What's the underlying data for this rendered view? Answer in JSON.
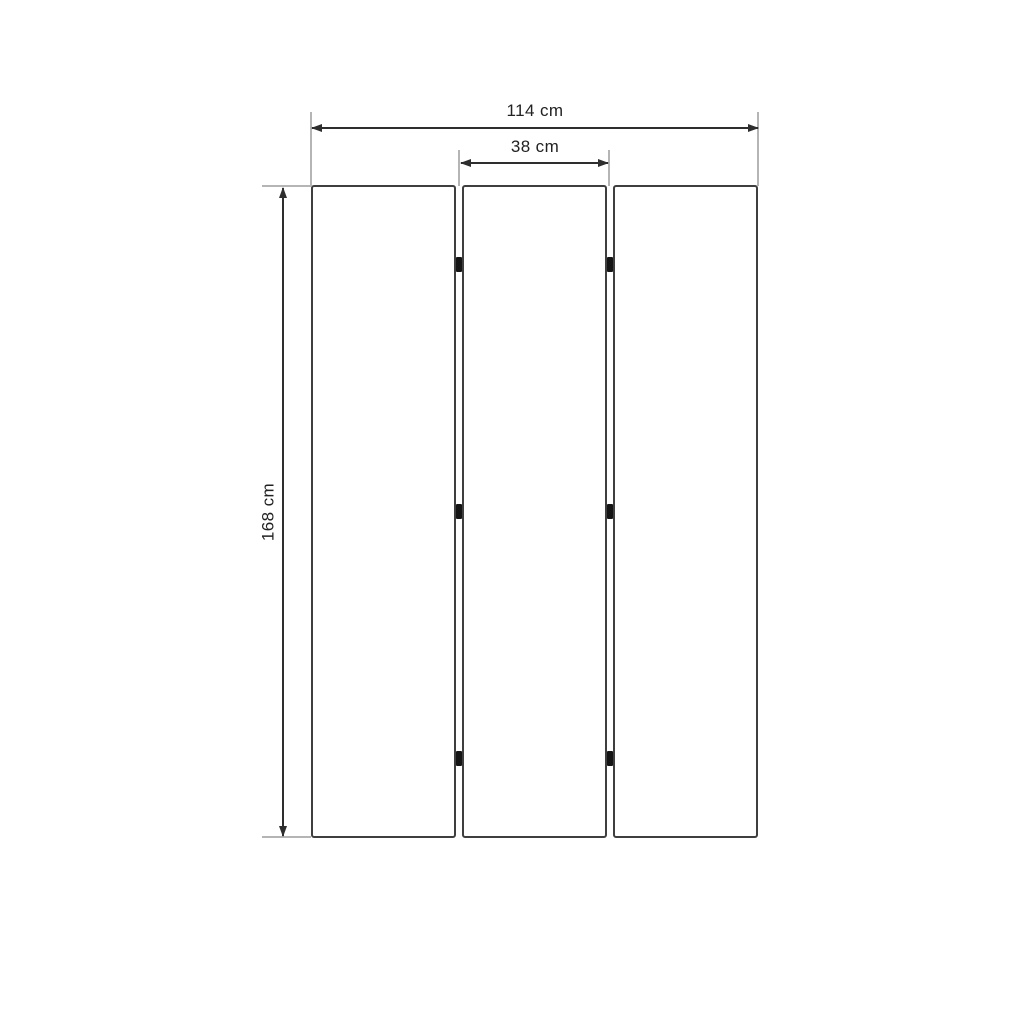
{
  "diagram": {
    "type": "dimension-drawing",
    "panels": {
      "count": 3,
      "hinge_rows_per_gap": 3,
      "gap_count": 2
    },
    "dimensions": {
      "total_width": {
        "label": "114 cm",
        "value": 114,
        "unit": "cm"
      },
      "panel_width": {
        "label": "38 cm",
        "value": 38,
        "unit": "cm"
      },
      "height": {
        "label": "168 cm",
        "value": 168,
        "unit": "cm"
      }
    },
    "colors": {
      "background": "#ffffff",
      "panel_border": "#3f3f3f",
      "dimension_line": "#2e2e2e",
      "extension_line": "#b5b5b5",
      "hinge": "#151515",
      "label_text": "#222222"
    }
  }
}
